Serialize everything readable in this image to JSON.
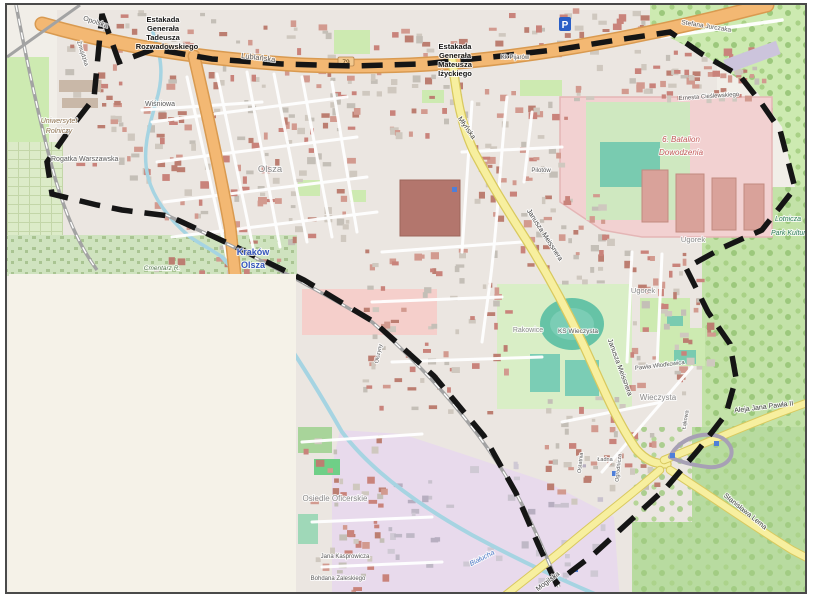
{
  "map": {
    "type": "street-map",
    "city_labels": [
      "Kraków Olsza"
    ],
    "badges": {
      "parking": "P",
      "road_ref": "79"
    },
    "colors": {
      "land": "#f1eee8",
      "residential": "#ebe6e1",
      "park": "#cdeab1",
      "park_dark": "#b8dba0",
      "military": "#f2d1d1",
      "water": "#a6d4e2",
      "purple_zone": "#e8daec",
      "road_orange": "#f3b873",
      "road_orange_casing": "#d99a50",
      "road_yellow": "#f7ef9f",
      "road_yellow_casing": "#d9c95e",
      "railway": "#a3a3a3",
      "boundary": "#151515",
      "overlay_box": "#f5f2e8",
      "stadium_track": "#66c3a6",
      "pitch": "#7bcdb5",
      "label_street": "#5a5a5a",
      "label_district": "#8a8a8a",
      "label_water": "#4a79c5",
      "label_station": "#3556bd",
      "label_park": "#2e7d5a",
      "label_military": "#c45c5c",
      "label_univ": "#8e7352",
      "label_cemetery": "#567a4f",
      "label_black": "#161616",
      "label_on_yellow": "#3f3f3f"
    },
    "boundary_points": [
      [
        100,
        12
      ],
      [
        117,
        60
      ],
      [
        152,
        47
      ],
      [
        210,
        57
      ],
      [
        280,
        62
      ],
      [
        350,
        64
      ],
      [
        420,
        62
      ],
      [
        490,
        55
      ],
      [
        560,
        47
      ],
      [
        615,
        38
      ],
      [
        668,
        30
      ],
      [
        700,
        52
      ],
      [
        738,
        74
      ],
      [
        760,
        102
      ],
      [
        778,
        128
      ],
      [
        793,
        186
      ],
      [
        760,
        228
      ],
      [
        722,
        245
      ],
      [
        684,
        266
      ],
      [
        706,
        310
      ],
      [
        728,
        342
      ],
      [
        734,
        376
      ],
      [
        724,
        412
      ],
      [
        697,
        447
      ],
      [
        664,
        486
      ],
      [
        630,
        517
      ],
      [
        592,
        552
      ],
      [
        554,
        581
      ],
      [
        536,
        542
      ],
      [
        514,
        491
      ],
      [
        482,
        434
      ],
      [
        432,
        374
      ],
      [
        372,
        320
      ],
      [
        302,
        278
      ],
      [
        232,
        244
      ],
      [
        167,
        214
      ],
      [
        120,
        208
      ],
      [
        95,
        203
      ],
      [
        50,
        192
      ],
      [
        45,
        160
      ],
      [
        68,
        127
      ],
      [
        92,
        96
      ]
    ],
    "labels": [
      {
        "id": "opolska",
        "text": "Opolska",
        "x": 93,
        "y": 22,
        "s": 7,
        "c": "label_street",
        "r": 18
      },
      {
        "id": "zmujdzka",
        "text": "Żmujdzka",
        "x": 79,
        "y": 52,
        "s": 6,
        "c": "label_street",
        "r": 72
      },
      {
        "id": "estakada-w-1",
        "text": "Estakada",
        "x": 161,
        "y": 20,
        "s": 7.5,
        "c": "label_black",
        "b": true
      },
      {
        "id": "estakada-w-2",
        "text": "Generała",
        "x": 161,
        "y": 29,
        "s": 7.5,
        "c": "label_black",
        "b": true
      },
      {
        "id": "estakada-w-3",
        "text": "Tadeusza",
        "x": 161,
        "y": 38,
        "s": 7.5,
        "c": "label_black",
        "b": true
      },
      {
        "id": "estakada-w-4",
        "text": "Rozwadowskiego",
        "x": 165,
        "y": 47,
        "s": 7.5,
        "c": "label_black",
        "b": true
      },
      {
        "id": "lublanska",
        "text": "Lublańska",
        "x": 256,
        "y": 58,
        "s": 7.5,
        "c": "label_street",
        "r": 7
      },
      {
        "id": "estakada-e-1",
        "text": "Estakada",
        "x": 453,
        "y": 47,
        "s": 7.5,
        "c": "label_black",
        "b": true
      },
      {
        "id": "estakada-e-2",
        "text": "Generała",
        "x": 453,
        "y": 56,
        "s": 7.5,
        "c": "label_black",
        "b": true
      },
      {
        "id": "estakada-e-3",
        "text": "Mateusza",
        "x": 453,
        "y": 65,
        "s": 7.5,
        "c": "label_black",
        "b": true
      },
      {
        "id": "estakada-e-4",
        "text": "Iżyckiego",
        "x": 453,
        "y": 74,
        "s": 7.5,
        "c": "label_black",
        "b": true
      },
      {
        "id": "jurczaka",
        "text": "Stefana Jurczaka",
        "x": 704,
        "y": 26,
        "s": 6.5,
        "c": "label_street",
        "r": 9
      },
      {
        "id": "pijarow",
        "text": "Kk Pijarów",
        "x": 513,
        "y": 57,
        "s": 6,
        "c": "label_street"
      },
      {
        "id": "wisniowa",
        "text": "Wiśniowa",
        "x": 158,
        "y": 104,
        "s": 7,
        "c": "label_street"
      },
      {
        "id": "uniwersytet-1",
        "text": "Uniwersytet",
        "x": 57,
        "y": 121,
        "s": 7,
        "c": "label_univ",
        "i": true
      },
      {
        "id": "uniwersytet-2",
        "text": "Rolniczy",
        "x": 57,
        "y": 131,
        "s": 7,
        "c": "label_univ",
        "i": true
      },
      {
        "id": "rogatka",
        "text": "Rogatka Warszawska",
        "x": 49,
        "y": 159,
        "s": 7,
        "c": "label_street",
        "a": "start"
      },
      {
        "id": "olsza-district",
        "text": "Olsza",
        "x": 268,
        "y": 170,
        "s": 9.5,
        "c": "label_district"
      },
      {
        "id": "krakow-olsza-1",
        "text": "Kraków",
        "x": 251,
        "y": 253,
        "s": 9,
        "c": "label_station",
        "b": true
      },
      {
        "id": "krakow-olsza-2",
        "text": "Olsza",
        "x": 251,
        "y": 266,
        "s": 9,
        "c": "label_station",
        "b": true
      },
      {
        "id": "cmentarz",
        "text": "Cmentarz R.",
        "x": 160,
        "y": 268,
        "s": 6.5,
        "c": "label_cemetery",
        "i": true
      },
      {
        "id": "mlynska",
        "text": "Młyńska",
        "x": 463,
        "y": 127,
        "s": 7,
        "c": "label_on_yellow",
        "r": 55
      },
      {
        "id": "meissnera-1",
        "text": "Janusza Meissnera",
        "x": 541,
        "y": 234,
        "s": 7,
        "c": "label_on_yellow",
        "r": 57
      },
      {
        "id": "meissnera-2",
        "text": "Janusza Meissnera",
        "x": 616,
        "y": 366,
        "s": 7,
        "c": "label_on_yellow",
        "r": 70
      },
      {
        "id": "cieslewskiego",
        "text": "Ernesta Cieślewskiego",
        "x": 707,
        "y": 96,
        "s": 6,
        "c": "label_street",
        "r": -4
      },
      {
        "id": "batalion-1",
        "text": "6. Batalion",
        "x": 679,
        "y": 140,
        "s": 8,
        "c": "label_military",
        "i": true
      },
      {
        "id": "batalion-2",
        "text": "Dowodzenia",
        "x": 679,
        "y": 153,
        "s": 8,
        "c": "label_military",
        "i": true
      },
      {
        "id": "park-kult-1",
        "text": "Lotnicza",
        "x": 773,
        "y": 219,
        "s": 7,
        "c": "label_park",
        "i": true,
        "a": "start"
      },
      {
        "id": "park-kult-2",
        "text": "Park Kulturowy",
        "x": 769,
        "y": 233,
        "s": 7,
        "c": "label_park",
        "i": true,
        "a": "start"
      },
      {
        "id": "ugorek-1",
        "text": "Ugorek",
        "x": 691,
        "y": 240,
        "s": 7.5,
        "c": "label_district"
      },
      {
        "id": "ugorek-2",
        "text": "Ugorek",
        "x": 641,
        "y": 291,
        "s": 7.5,
        "c": "label_district"
      },
      {
        "id": "pilotow",
        "text": "Pilotów",
        "x": 539,
        "y": 170,
        "s": 6,
        "c": "label_street"
      },
      {
        "id": "wlodkowica",
        "text": "Pawła Włodkowica",
        "x": 658,
        "y": 365,
        "s": 6,
        "c": "label_street",
        "r": -7
      },
      {
        "id": "wieczysta-district",
        "text": "Wieczysta",
        "x": 656,
        "y": 398,
        "s": 8,
        "c": "label_district"
      },
      {
        "id": "rakowice",
        "text": "Rakowice",
        "x": 526,
        "y": 330,
        "s": 7,
        "c": "label_district"
      },
      {
        "id": "ks-wieczysta",
        "text": "KS Wieczysta",
        "x": 576,
        "y": 331,
        "s": 6.5,
        "c": "label_street"
      },
      {
        "id": "oficerskie",
        "text": "Osiedle Oficerskie",
        "x": 333,
        "y": 499,
        "s": 8,
        "c": "label_district"
      },
      {
        "id": "kasprowicza",
        "text": "Jana Kasprowicza",
        "x": 343,
        "y": 556,
        "s": 6,
        "c": "label_street"
      },
      {
        "id": "zaleskiego",
        "text": "Bohdana Zaleskiego",
        "x": 336,
        "y": 578,
        "s": 6,
        "c": "label_street"
      },
      {
        "id": "bialucha",
        "text": "Białucha",
        "x": 481,
        "y": 558,
        "s": 7,
        "c": "label_water",
        "i": true,
        "r": -27
      },
      {
        "id": "mogilska",
        "text": "Mogilska",
        "x": 547,
        "y": 581,
        "s": 7,
        "c": "label_on_yellow",
        "r": -37
      },
      {
        "id": "lema",
        "text": "Stanisława Lema",
        "x": 742,
        "y": 511,
        "s": 7,
        "c": "label_on_yellow",
        "r": 39
      },
      {
        "id": "jana-pawla",
        "text": "Aleja Jana Pawła II",
        "x": 762,
        "y": 407,
        "s": 7,
        "c": "label_on_yellow",
        "r": -7
      },
      {
        "id": "ostatnia",
        "text": "Ostatnia",
        "x": 580,
        "y": 461,
        "s": 5.5,
        "c": "label_street",
        "r": -84
      },
      {
        "id": "ogrodnicza",
        "text": "Ogrodnicza",
        "x": 618,
        "y": 466,
        "s": 5.5,
        "c": "label_street",
        "r": -84
      },
      {
        "id": "lakowa",
        "text": "Łąkowa",
        "x": 685,
        "y": 418,
        "s": 5.5,
        "c": "label_street",
        "r": -80
      },
      {
        "id": "olszyny",
        "text": "Olszyny",
        "x": 378,
        "y": 352,
        "s": 5.5,
        "c": "label_street",
        "r": -78
      },
      {
        "id": "ladna",
        "text": "Ładna",
        "x": 603,
        "y": 459,
        "s": 5.5,
        "c": "label_street"
      }
    ]
  }
}
